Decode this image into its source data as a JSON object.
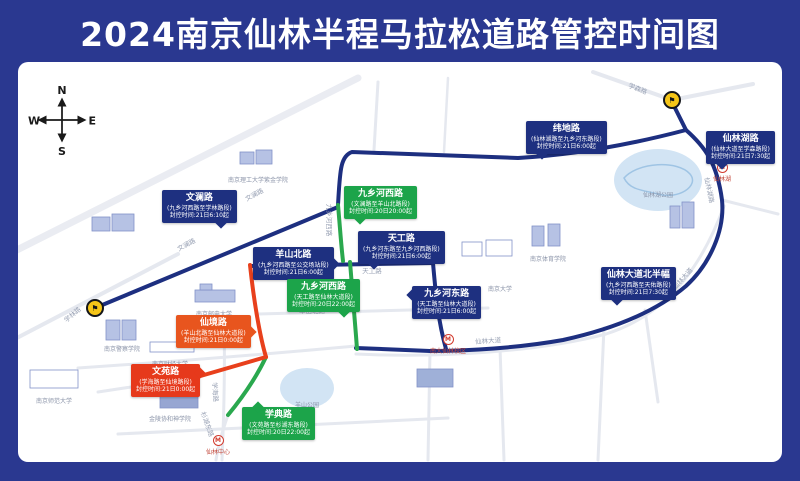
{
  "title": "2024南京仙林半程马拉松道路管控时间图",
  "compass": {
    "n": "N",
    "e": "E",
    "s": "S",
    "w": "W"
  },
  "colors": {
    "frame": "#2a3890",
    "navy": "#1e3080",
    "green": "#1ca44a",
    "red": "#e6391b",
    "orange": "#e8551e",
    "route_blue": "#1d2f80",
    "route_green": "#2aa84e",
    "route_red": "#e8401c",
    "marker_yellow": "#f5c518"
  },
  "marker_icon": "⚑",
  "metro_icon": "M",
  "control_labels": [
    {
      "road": "文澜路",
      "section": "(九乡河西路至学林路段)",
      "time": "封控时间:21日6:10起",
      "color": "navy",
      "x": 144,
      "y": 128,
      "tail": "br"
    },
    {
      "road": "九乡河西路",
      "section": "(文澜路至羊山北路段)",
      "time": "封控时间:20日20:00起",
      "color": "green",
      "x": 326,
      "y": 124,
      "tail": "bl"
    },
    {
      "road": "天工路",
      "section": "(九乡河东路至九乡河西路段)",
      "time": "封控时间:21日6:00起",
      "color": "navy",
      "x": 340,
      "y": 169,
      "tail": "bl"
    },
    {
      "road": "羊山北路",
      "section": "(九乡河西路至公交场站段)",
      "time": "封控时间:21日6:00起",
      "color": "navy",
      "x": 235,
      "y": 185,
      "tail": "r"
    },
    {
      "road": "九乡河西路",
      "section": "(天工路至仙林大道段)",
      "time": "封控时间:20日22:00起",
      "color": "green",
      "x": 269,
      "y": 217,
      "tail": "br"
    },
    {
      "road": "仙境路",
      "section": "(羊山北路至仙林大道段)",
      "time": "封控时间:21日0:00起",
      "color": "orange",
      "x": 158,
      "y": 253,
      "tail": "r"
    },
    {
      "road": "文苑路",
      "section": "(学海路至仙境路段)",
      "time": "封控时间:21日0:00起",
      "color": "red",
      "x": 113,
      "y": 302,
      "tail": "rt"
    },
    {
      "road": "学典路",
      "section": "(文苑路至杉湖东路段)",
      "time": "封控时间:20日22:00起",
      "color": "green",
      "x": 224,
      "y": 345,
      "tail": "tl"
    },
    {
      "road": "纬地路",
      "section": "(仙林湖路至九乡河东路段)",
      "time": "封控时间:21日6:00起",
      "color": "navy",
      "x": 508,
      "y": 59,
      "tail": "bl"
    },
    {
      "road": "仙林湖路",
      "section": "(仙林大道至学森路段)",
      "time": "封控时间:21日7:30起",
      "color": "navy",
      "x": 688,
      "y": 69,
      "tail": "bl"
    },
    {
      "road": "九乡河东路",
      "section": "(天工路至仙林大道段)",
      "time": "封控时间:21日6:00起",
      "color": "navy",
      "x": 394,
      "y": 224,
      "tail": "lt"
    },
    {
      "road": "仙林大道北半幅",
      "section": "(九乡河西路至天佑路段)",
      "time": "封控时间:21日7:30起",
      "color": "navy",
      "x": 583,
      "y": 205,
      "tail": "bl"
    }
  ],
  "road_labels": [
    {
      "t": "学林路",
      "x": 54,
      "y": 252,
      "r": -40
    },
    {
      "t": "文澜路",
      "x": 236,
      "y": 132,
      "r": -28
    },
    {
      "t": "文澜路",
      "x": 168,
      "y": 182,
      "r": -28
    },
    {
      "t": "九乡河西路",
      "x": 312,
      "y": 158,
      "r": 90
    },
    {
      "t": "天工路",
      "x": 354,
      "y": 208,
      "r": 0
    },
    {
      "t": "羊山北路",
      "x": 294,
      "y": 248,
      "r": 0
    },
    {
      "t": "学森路",
      "x": 620,
      "y": 26,
      "r": 22
    },
    {
      "t": "纬地路",
      "x": 566,
      "y": 80,
      "r": -6
    },
    {
      "t": "仙林湖路",
      "x": 692,
      "y": 128,
      "r": 78
    },
    {
      "t": "九乡河东路",
      "x": 406,
      "y": 240,
      "r": 82
    },
    {
      "t": "仙林大道",
      "x": 470,
      "y": 278,
      "r": -4
    },
    {
      "t": "仙林大道",
      "x": 664,
      "y": 216,
      "r": -48
    },
    {
      "t": "学海路",
      "x": 198,
      "y": 330,
      "r": 86
    },
    {
      "t": "杉湖东路",
      "x": 190,
      "y": 362,
      "r": 70
    }
  ],
  "pois": [
    {
      "t": "南京理工大学紫金学院",
      "x": 240,
      "y": 113
    },
    {
      "t": "南京大学",
      "x": 482,
      "y": 222
    },
    {
      "t": "南京体育学院",
      "x": 530,
      "y": 192
    },
    {
      "t": "南京邮电大学",
      "x": 196,
      "y": 247
    },
    {
      "t": "南京警察学院",
      "x": 104,
      "y": 282
    },
    {
      "t": "南京财经大学",
      "x": 152,
      "y": 297
    },
    {
      "t": "南京师范大学",
      "x": 36,
      "y": 334
    },
    {
      "t": "金陵协和神学院",
      "x": 152,
      "y": 352
    },
    {
      "t": "仙林湖公园",
      "x": 640,
      "y": 128
    },
    {
      "t": "羊山公园",
      "x": 289,
      "y": 338
    }
  ],
  "metro_stations": [
    {
      "name": "仙林湖",
      "x": 704,
      "y": 100
    },
    {
      "name": "南大仙林校区",
      "x": 430,
      "y": 272
    },
    {
      "name": "仙林中心",
      "x": 200,
      "y": 373
    }
  ],
  "route_markers": [
    {
      "x": 654,
      "y": 38
    },
    {
      "x": 77,
      "y": 246
    }
  ]
}
